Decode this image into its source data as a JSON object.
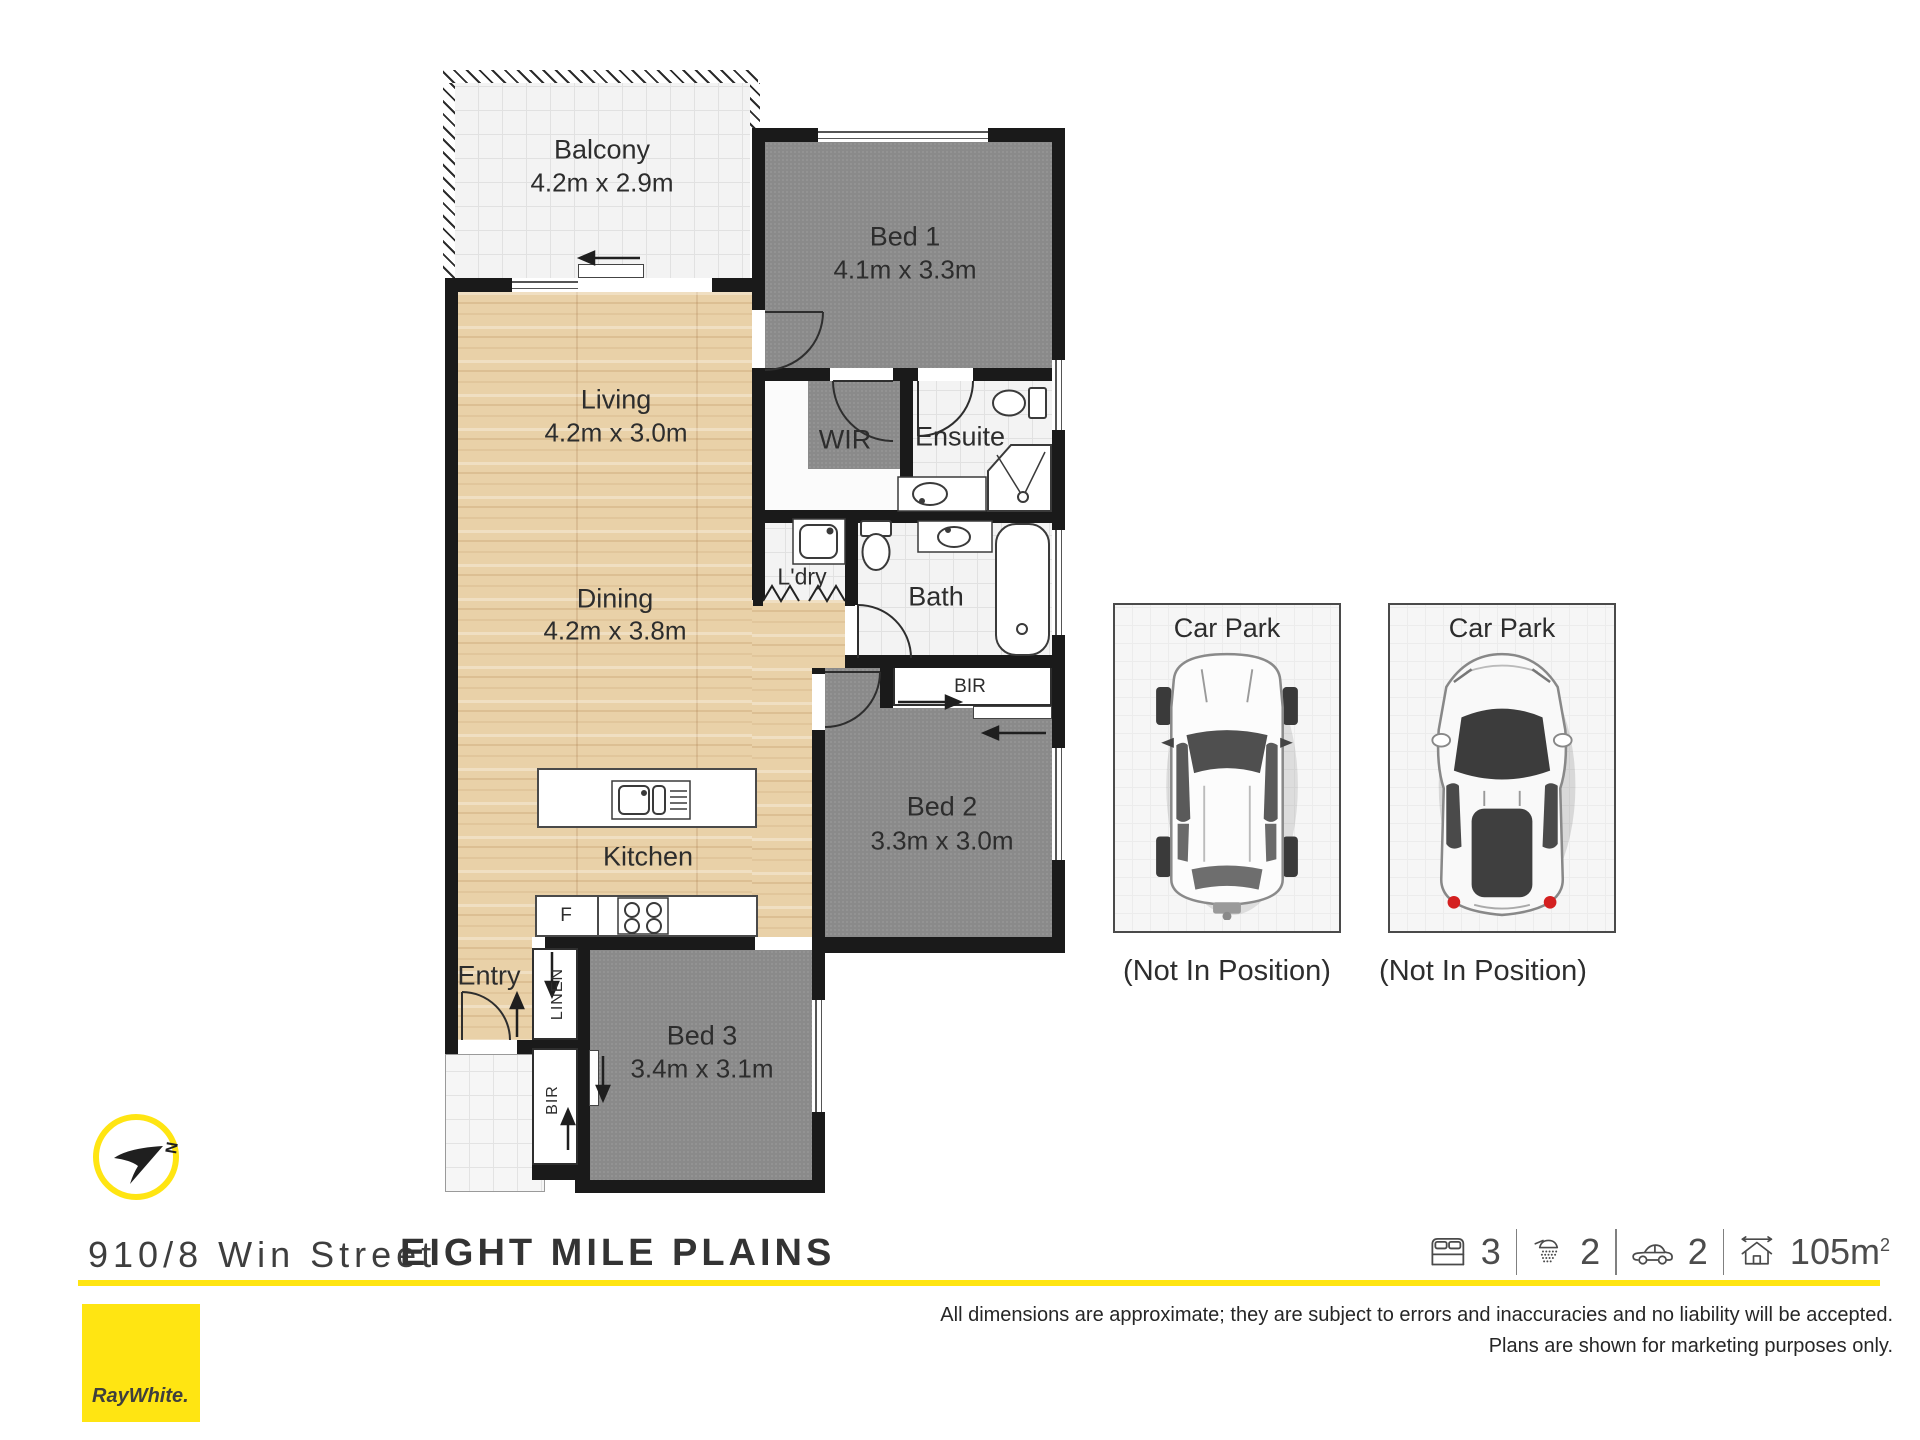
{
  "plan": {
    "rooms": {
      "balcony": {
        "name": "Balcony",
        "dims": "4.2m x 2.9m"
      },
      "bed1": {
        "name": "Bed 1",
        "dims": "4.1m x 3.3m"
      },
      "living": {
        "name": "Living",
        "dims": "4.2m x 3.0m"
      },
      "dining": {
        "name": "Dining",
        "dims": "4.2m x 3.8m"
      },
      "wir": {
        "name": "WIR"
      },
      "ensuite": {
        "name": "Ensuite"
      },
      "ldry": {
        "name": "L'dry"
      },
      "bath": {
        "name": "Bath"
      },
      "bed2": {
        "name": "Bed 2",
        "dims": "3.3m x 3.0m"
      },
      "kitchen": {
        "name": "Kitchen"
      },
      "entry": {
        "name": "Entry"
      },
      "bed3": {
        "name": "Bed 3",
        "dims": "3.4m x 3.1m"
      },
      "fridge_label": "F",
      "linen_label": "LINEN",
      "bir_bed2_label": "BIR",
      "bir_bed3_label": "BIR"
    },
    "carparks": [
      {
        "title": "Car Park",
        "note": "(Not In Position)"
      },
      {
        "title": "Car Park",
        "note": "(Not In Position)"
      }
    ],
    "compass_north": "N"
  },
  "footer": {
    "address": "910/8 Win Street",
    "suburb": "EIGHT MILE PLAINS",
    "stats": {
      "beds": "3",
      "baths": "2",
      "cars": "2",
      "area": "105m",
      "area_sup": "2"
    },
    "disclaimer1": "All dimensions are approximate; they are subject to errors and inaccuracies and no liability will be accepted.",
    "disclaimer2": "Plans are shown for marketing purposes only.",
    "brand": "RayWhite."
  },
  "colors": {
    "accent": "#ffe512",
    "wall": "#1a1a1a",
    "carpet": "#8a8a8a",
    "wood": "#e9d1a8"
  }
}
